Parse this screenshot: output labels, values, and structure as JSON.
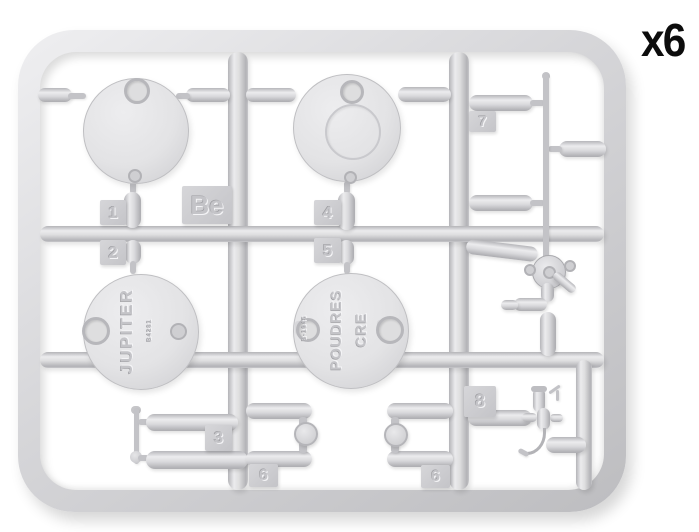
{
  "quantity_label": "x6",
  "sprue_letter": "Be",
  "part_tags": {
    "t1": "1",
    "t2": "2",
    "t3": "3",
    "t4": "4",
    "t5": "5",
    "t6": "6",
    "t7": "7",
    "t8": "8"
  },
  "discs": {
    "jupiter": {
      "brand": "JUPITER",
      "code": "B4281"
    },
    "poudres": {
      "line1": "POUDRES",
      "line2": "CRE",
      "code": "B-1945"
    }
  },
  "colors": {
    "plastic": "#d6d6d9",
    "plastic_highlight": "#ececee",
    "plastic_shadow": "#b2b2b6",
    "tag": "#c9c9cc",
    "emboss_text": "#c4c4c8",
    "quantity_text": "#0c0c0c",
    "background": "#ffffff"
  }
}
